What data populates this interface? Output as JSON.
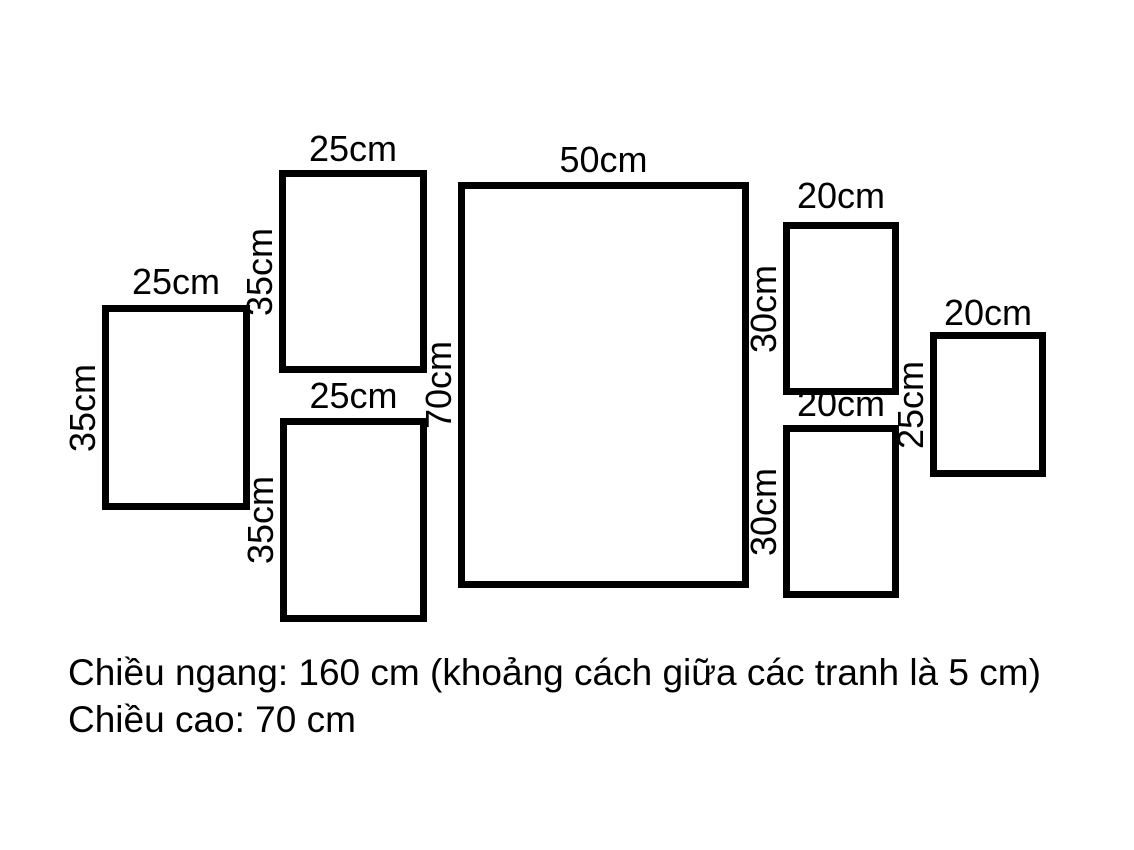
{
  "diagram": {
    "frames": [
      {
        "name": "left-frame",
        "width_cm": "25cm",
        "height_cm": "35cm"
      },
      {
        "name": "middle-top-frame",
        "width_cm": "25cm",
        "height_cm": "35cm"
      },
      {
        "name": "middle-bottom-frame",
        "width_cm": "25cm",
        "height_cm": "35cm"
      },
      {
        "name": "center-frame",
        "width_cm": "50cm",
        "height_cm": "70cm"
      },
      {
        "name": "right-top-frame",
        "width_cm": "20cm",
        "height_cm": "30cm"
      },
      {
        "name": "right-bottom-frame",
        "width_cm": "20cm",
        "height_cm": "30cm"
      },
      {
        "name": "far-right-frame",
        "width_cm": "20cm",
        "height_cm": "25cm"
      }
    ],
    "caption": {
      "line1": "Chiều ngang: 160 cm (khoảng cách giữa các tranh là 5 cm)",
      "line2": "Chiều cao: 70 cm"
    },
    "colors": {
      "border": "#000000",
      "background": "#ffffff",
      "text": "#000000"
    }
  }
}
